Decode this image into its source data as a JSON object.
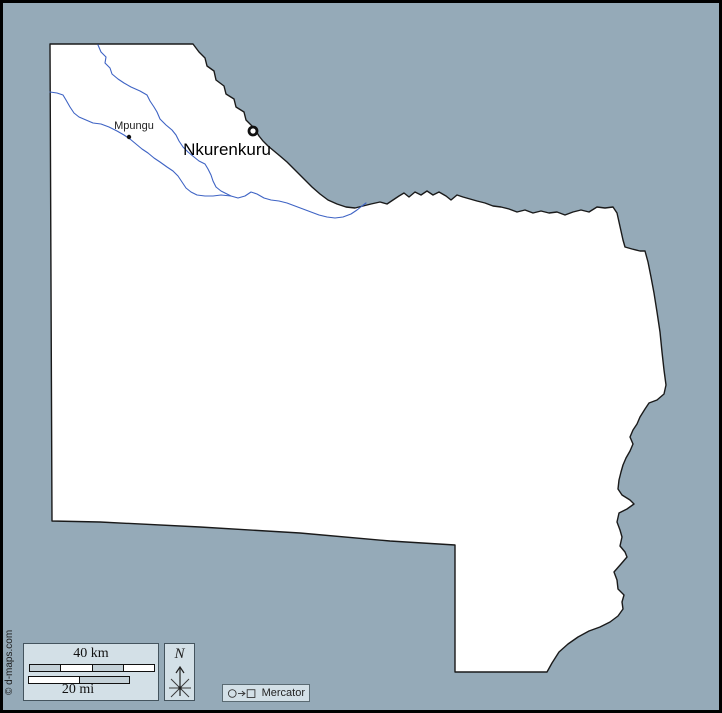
{
  "places": {
    "capital": "Nkurenkuru",
    "town": "Mpungu"
  },
  "scale_box": {
    "km_label": "40 km",
    "mi_label": "20 mi"
  },
  "compass": {
    "north_label": "N"
  },
  "projection": {
    "name": "Mercator"
  },
  "copyright": "© d-maps.com",
  "colors": {
    "sea": "#95AAB8",
    "land": "#FFFFFF",
    "border": "#1A1A1A",
    "river": "#3E63C4",
    "panel": "#D3E0E7",
    "panel_border": "#44545E",
    "bar_gray": "#C4D1D8",
    "frame": "#000000"
  }
}
